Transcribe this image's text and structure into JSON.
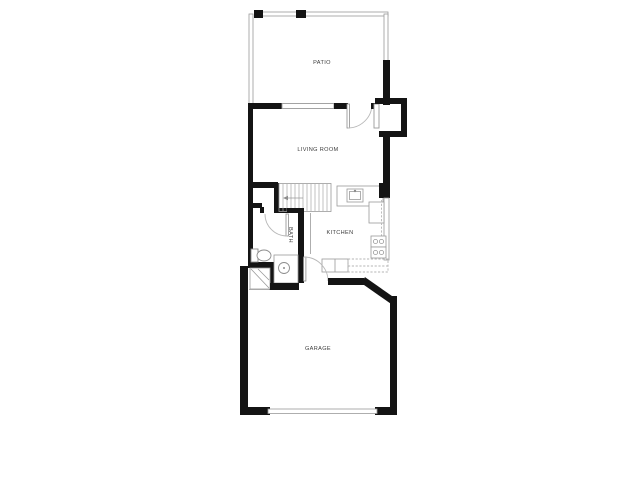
{
  "plan": {
    "type": "residential-floor-plan",
    "rooms": {
      "patio": {
        "label": "PATIO"
      },
      "living_room": {
        "label": "LIVING ROOM"
      },
      "kitchen": {
        "label": "KITCHEN"
      },
      "bath": {
        "label": "BATH"
      },
      "garage": {
        "label": "GARAGE"
      }
    },
    "fixtures": [
      "patio-fence",
      "front-door",
      "entry-window",
      "living-room-window",
      "stairs",
      "stairs-direction-arrow",
      "bath-door",
      "toilet",
      "bath-vanity-sink",
      "water-heater",
      "kitchen-sink",
      "stove-burners",
      "refrigerator",
      "upper-cabinets-dashed",
      "garage-entry-door",
      "garage-overhead-door"
    ],
    "colors": {
      "background": "#ffffff",
      "wall": "#141414",
      "thin_line": "#9a9a9a",
      "dash_line": "#b5b5b5",
      "label": "#3c3c3c"
    }
  }
}
